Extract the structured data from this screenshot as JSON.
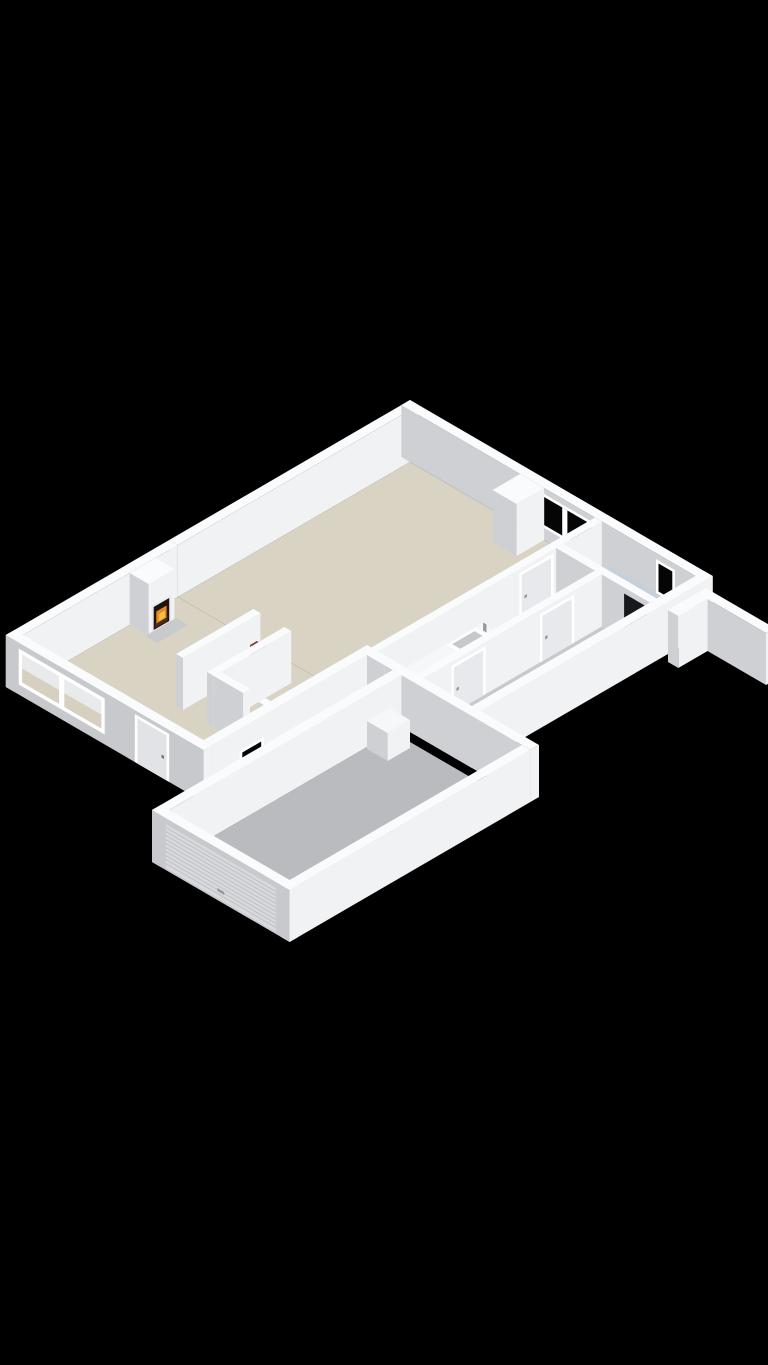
{
  "scene": {
    "type": "3d-floorplan-isometric-render",
    "description": "Isometric 3D cutaway floor plan of a single-storey house with attached garage on black background",
    "background": "#000000",
    "rooms": [
      "living-room",
      "dining-area",
      "kitchen",
      "hallway",
      "entry",
      "storage-niche",
      "wc",
      "corridor",
      "bedroom",
      "bathroom",
      "garage"
    ],
    "objects": [
      "fireplace-with-fire",
      "hearth-plate",
      "kitchen-counter-with-sink",
      "book-shelf-niche",
      "bathtub",
      "double-window",
      "bathroom-window",
      "large-front-window",
      "front-door",
      "interior-doors",
      "garage-roller-door",
      "garage-unit-box",
      "garden-wall"
    ],
    "colors": {
      "background": "#000000",
      "wallTop": "#fafbfc",
      "wallRight": "#f1f2f4",
      "wallLeft": "#ced0d3",
      "wallLeftExt": "#c7c9cc",
      "floorBeige": "#d9d3c3",
      "floorGray": "#c8c9cb",
      "floorGarage": "#babbbe",
      "glassDark": "#050505",
      "frameWhite": "#ffffff",
      "doorPanel": "#e8e9ec",
      "doorPanelExt": "#e2e3e6",
      "handle": "#97989c",
      "handleDark": "#6f7073",
      "rollerDoor": "#d8d9dc",
      "rollerLine": "#bcbdc1",
      "fireboxDark": "#1d1410",
      "flameOrange": "#e8891d",
      "flameYellow": "#f6c14a",
      "log": "#4a2c18",
      "hearth": "#c9cacd",
      "counterTop": "#f6f7f8",
      "counterSide": "#dadbde",
      "counterCap": "#d8d9db",
      "sinkBasin": "#c6c8cb",
      "tubTop": "#c6d0dc",
      "tubSide": "#b3bfcc",
      "bookRed": "#7a3b2e",
      "bookDark": "#332f2c",
      "bookRust": "#8a4a35",
      "darkDoorway": "#17181c",
      "doorwayDetail": "#9fb4c7",
      "windowInteriorUpper": "#e9eaeb",
      "windowInteriorLower": "#d6d0c0"
    }
  }
}
